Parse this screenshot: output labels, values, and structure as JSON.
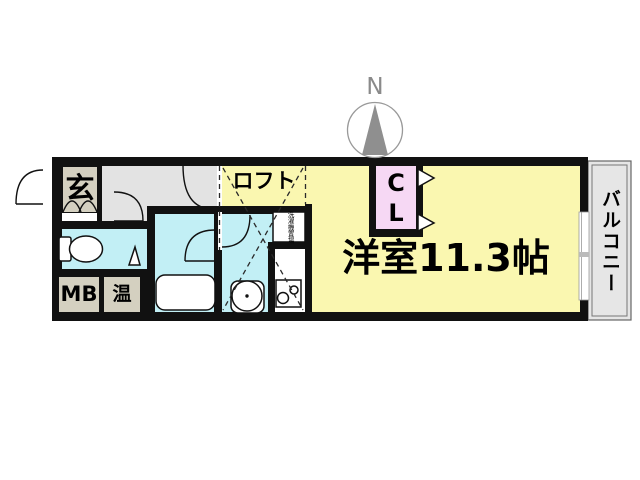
{
  "floorplan": {
    "compass": {
      "label": "N"
    },
    "labels": {
      "entrance": "玄",
      "loft": "ロフト",
      "closet_line1": "C",
      "closet_line2": "L",
      "main_room": "洋室11.3帖",
      "balcony": "バルコニー",
      "meter_box": "MB",
      "water_heater": "温",
      "washer": "洗濯機置場"
    },
    "colors": {
      "wall": "#111111",
      "room_yellow": "#faf7b0",
      "wet_cyan": "#c2eff5",
      "hall_gray": "#e3e3e3",
      "box_beige": "#d4d0c0",
      "closet_pink": "#f6d8f4",
      "balcony_gray": "#e6e6e6",
      "compass_gray": "#8f8f8f",
      "white": "#ffffff"
    }
  }
}
